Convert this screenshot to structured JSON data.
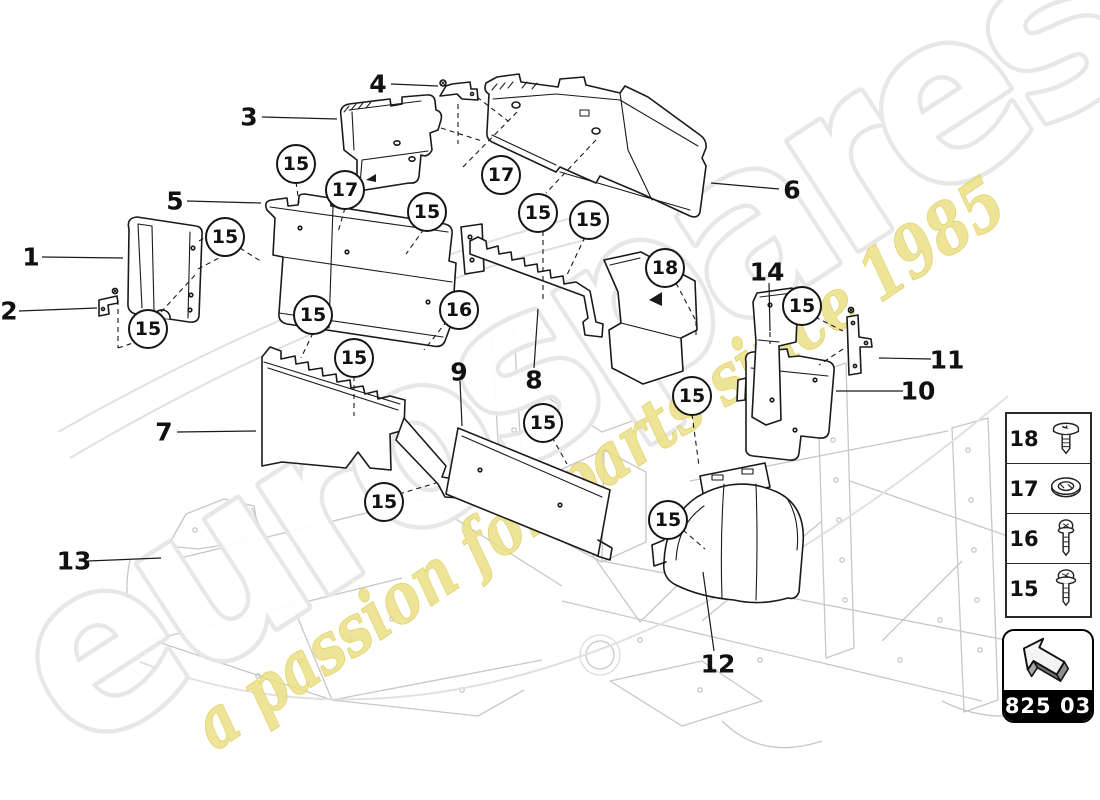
{
  "diagram": {
    "description": "Heat shield exploded parts diagram",
    "watermark": {
      "brand": "eurospares",
      "tagline": "a passion for parts since 1985",
      "brand_color": "#ececec",
      "tagline_color": "#e9db7c"
    },
    "colors": {
      "part_line": "#1a1a1a",
      "chassis_line": "#c7c7c7",
      "callout_text": "#111111",
      "code_box_bg": "#000000",
      "code_box_text": "#ffffff"
    },
    "callouts": [
      {
        "label": "1",
        "type": "plain",
        "x": 31,
        "y": 257
      },
      {
        "label": "2",
        "type": "plain",
        "x": 9,
        "y": 311
      },
      {
        "label": "3",
        "type": "plain",
        "x": 249,
        "y": 117
      },
      {
        "label": "4",
        "type": "plain",
        "x": 378,
        "y": 84
      },
      {
        "label": "5",
        "type": "plain",
        "x": 175,
        "y": 201
      },
      {
        "label": "6",
        "type": "plain",
        "x": 792,
        "y": 190
      },
      {
        "label": "7",
        "type": "plain",
        "x": 164,
        "y": 432
      },
      {
        "label": "8",
        "type": "plain",
        "x": 534,
        "y": 380
      },
      {
        "label": "9",
        "type": "plain",
        "x": 459,
        "y": 372
      },
      {
        "label": "10",
        "type": "plain",
        "x": 918,
        "y": 391
      },
      {
        "label": "11",
        "type": "plain",
        "x": 947,
        "y": 360
      },
      {
        "label": "12",
        "type": "plain",
        "x": 718,
        "y": 664
      },
      {
        "label": "13",
        "type": "plain",
        "x": 74,
        "y": 561
      },
      {
        "label": "14",
        "type": "plain",
        "x": 767,
        "y": 272
      },
      {
        "label": "15",
        "type": "circled",
        "x": 296,
        "y": 164
      },
      {
        "label": "17",
        "type": "circled",
        "x": 345,
        "y": 190
      },
      {
        "label": "15",
        "type": "circled",
        "x": 427,
        "y": 212
      },
      {
        "label": "15",
        "type": "circled",
        "x": 225,
        "y": 237
      },
      {
        "label": "15",
        "type": "circled",
        "x": 148,
        "y": 329
      },
      {
        "label": "15",
        "type": "circled",
        "x": 313,
        "y": 315
      },
      {
        "label": "16",
        "type": "circled",
        "x": 459,
        "y": 310
      },
      {
        "label": "15",
        "type": "circled",
        "x": 354,
        "y": 358
      },
      {
        "label": "17",
        "type": "circled",
        "x": 501,
        "y": 175
      },
      {
        "label": "15",
        "type": "circled",
        "x": 538,
        "y": 213
      },
      {
        "label": "15",
        "type": "circled",
        "x": 589,
        "y": 220
      },
      {
        "label": "18",
        "type": "circled",
        "x": 665,
        "y": 268
      },
      {
        "label": "15",
        "type": "circled",
        "x": 802,
        "y": 306
      },
      {
        "label": "15",
        "type": "circled",
        "x": 692,
        "y": 396
      },
      {
        "label": "15",
        "type": "circled",
        "x": 384,
        "y": 502
      },
      {
        "label": "15",
        "type": "circled",
        "x": 543,
        "y": 423
      },
      {
        "label": "15",
        "type": "circled",
        "x": 668,
        "y": 520
      }
    ],
    "legend": {
      "rows": [
        {
          "number": "18",
          "icon": "flanged-screw-icon"
        },
        {
          "number": "17",
          "icon": "plastic-nut-icon"
        },
        {
          "number": "16",
          "icon": "pan-head-screw-icon"
        },
        {
          "number": "15",
          "icon": "washer-head-screw-icon"
        }
      ]
    },
    "part_code": {
      "label": "825 03"
    }
  }
}
